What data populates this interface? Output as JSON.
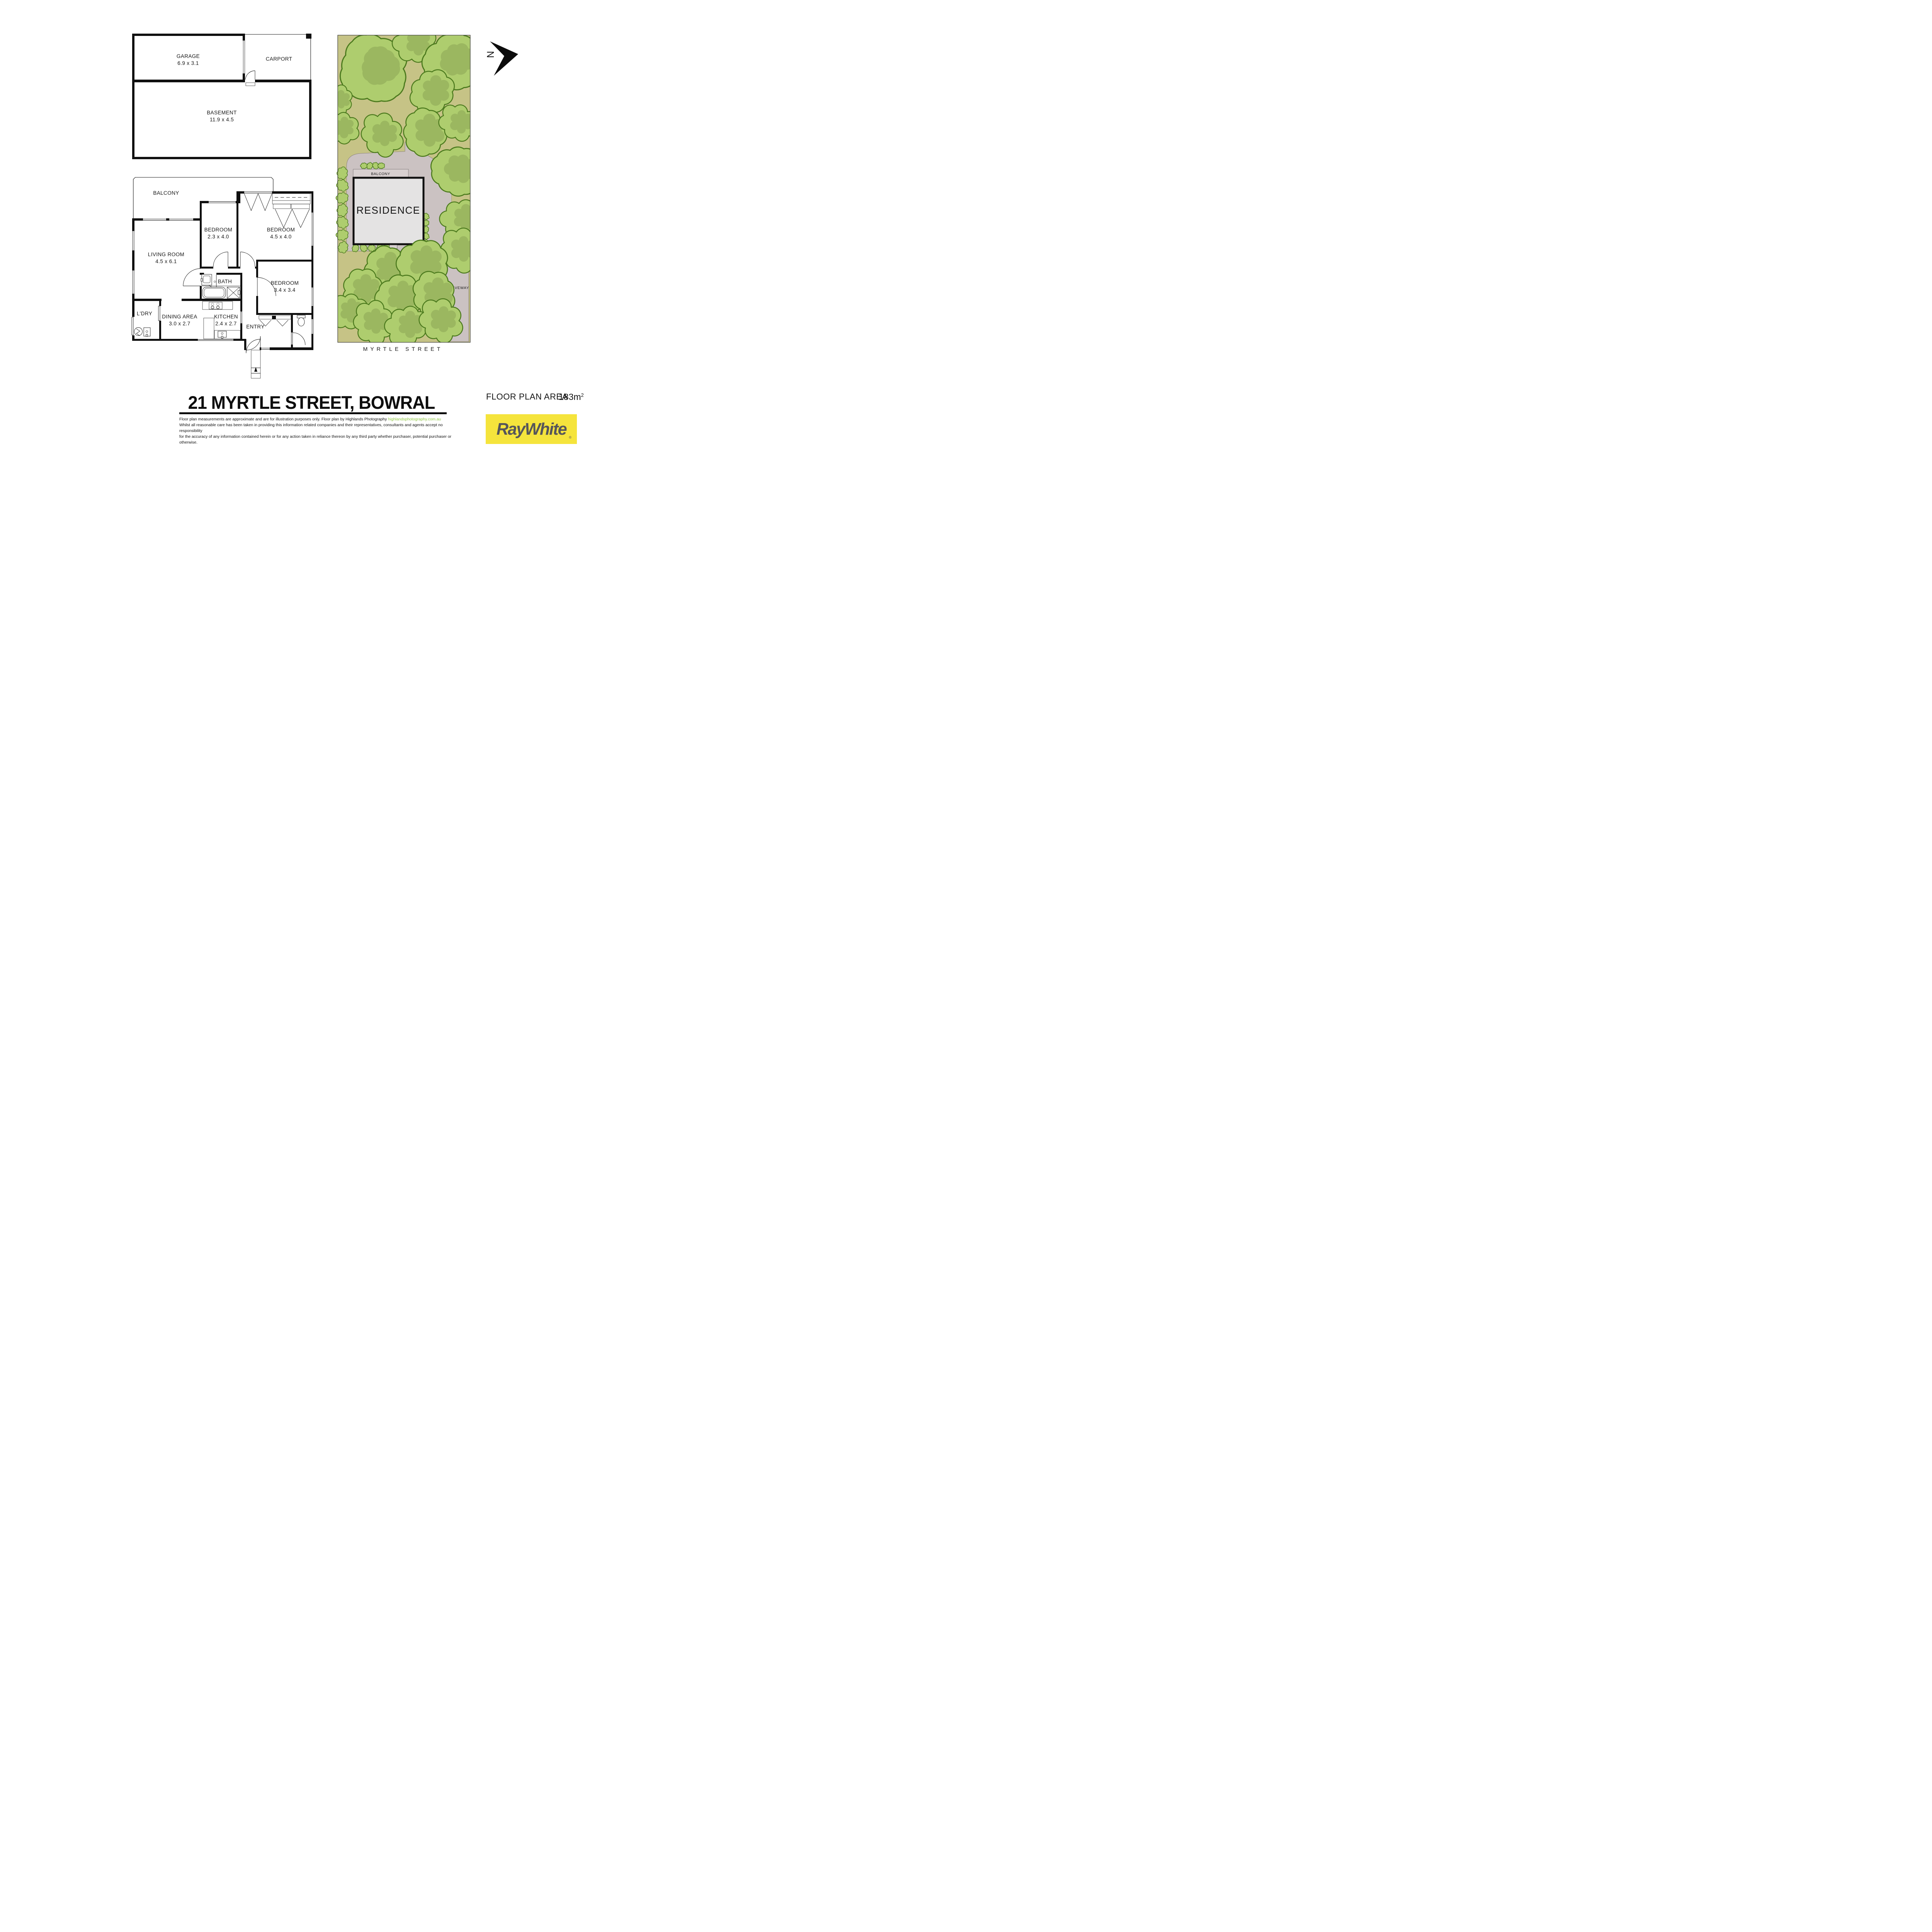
{
  "garage_plan": {
    "garage": {
      "name": "GARAGE",
      "dims": "6.9 x 3.1"
    },
    "carport": {
      "name": "CARPORT"
    },
    "basement": {
      "name": "BASEMENT",
      "dims": "11.9 x 4.5"
    }
  },
  "floor_plan": {
    "balcony": "BALCONY",
    "living": {
      "name": "LIVING ROOM",
      "dims": "4.5 x 6.1"
    },
    "bedroom1": {
      "name": "BEDROOM",
      "dims": "2.3 x 4.0"
    },
    "bedroom2": {
      "name": "BEDROOM",
      "dims": "4.5 x 4.0"
    },
    "bedroom3": {
      "name": "BEDROOM",
      "dims": "3.4 x 3.4"
    },
    "bath": "BATH",
    "laundry": "L'DRY",
    "dining": {
      "name": "DINING AREA",
      "dims": "3.0 x 2.7"
    },
    "kitchen": {
      "name": "KITCHEN",
      "dims": "2.4 x 2.7"
    },
    "entry": "ENTRY"
  },
  "site_plan": {
    "balcony": "BALCONY",
    "residence": "RESIDENCE",
    "driveway": "DRIVEWAY",
    "street": "MYRTLE STREET"
  },
  "compass": {
    "north": "N"
  },
  "footer": {
    "title": "21 MYRTLE STREET, BOWRAL",
    "disclaimer_1": "Floor plan measurements are approximate and are for illustration purposes only. Floor plan by Highlands Photography",
    "disclaimer_link": "highlandsphotography.com.au",
    "disclaimer_2": "Whilst all reasonable care has been taken in providing this information related companies and their representatives, consultants and agents accept no responsibility",
    "disclaimer_3": "for the accuracy of any information contained herein or for any action taken in reliance thereon by any third party whether purchaser, potential purchaser or otherwise.",
    "area_label": "FLOOR PLAN AREA",
    "area_value": "183m",
    "area_superscript": "2",
    "brand": "RayWhite",
    "registered": "®"
  },
  "colors": {
    "link_green": "#8dc63f",
    "brand_yellow": "#f5e43c",
    "brand_gray": "#56565a",
    "tree_fill": "#aecd6e",
    "tree_stroke": "#4c7a1e",
    "tree_shade": "#87a251",
    "grass": "#c6c386",
    "pavement": "#cbc2c2",
    "pavement_edge": "#7d7672",
    "residence_fill": "#e4e3e3",
    "balcony_fill": "#d8d0d0"
  }
}
